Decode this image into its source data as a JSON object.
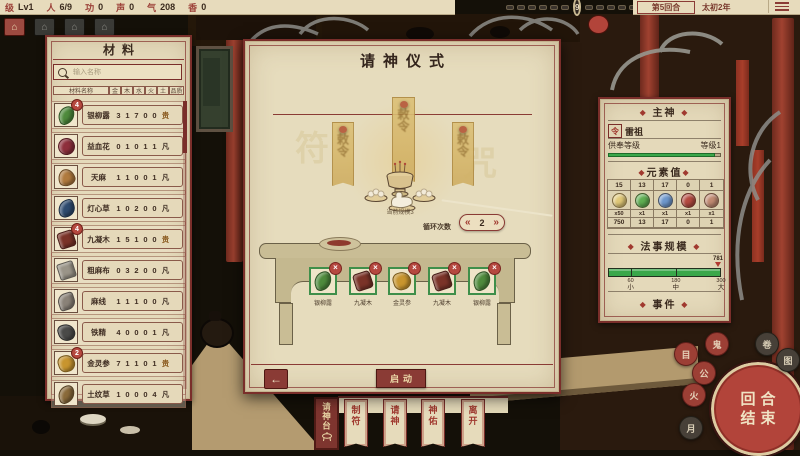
{
  "top_bar": {
    "stats": [
      {
        "label": "级",
        "value": "Lv1"
      },
      {
        "label": "人",
        "value": "6/9"
      },
      {
        "label": "功",
        "value": "0"
      },
      {
        "label": "声",
        "value": "0"
      },
      {
        "label": "气",
        "value": "208"
      },
      {
        "label": "香",
        "value": "0"
      }
    ],
    "turn_badge": "9",
    "round": "第5回合",
    "year": "太初2年"
  },
  "view_buttons": [
    {
      "name": "view-toggle-1",
      "glyph": "⌂",
      "active": true
    },
    {
      "name": "view-toggle-2",
      "glyph": "⌂",
      "active": false
    },
    {
      "name": "view-toggle-3",
      "glyph": "⌂",
      "active": false
    },
    {
      "name": "view-toggle-4",
      "glyph": "⌂",
      "active": false
    }
  ],
  "materials": {
    "title": "材料",
    "search_placeholder": "输入名称",
    "header": {
      "name": "材料名称",
      "elements": [
        "金",
        "木",
        "水",
        "火",
        "土"
      ],
      "quality": "品质"
    },
    "quality_colors": {
      "贵": "#8a5a1e",
      "凡": "#4a3a2e"
    },
    "items": [
      {
        "name": "银柳露",
        "values": [
          "3",
          "1",
          "7",
          "0",
          "0"
        ],
        "quality": "贵",
        "badge": "4",
        "color": "#4e8a3c",
        "shape": "leaf"
      },
      {
        "name": "益血花",
        "values": [
          "0",
          "1",
          "0",
          "1",
          "1"
        ],
        "quality": "凡",
        "badge": "",
        "color": "#8e2f3c",
        "shape": "flower"
      },
      {
        "name": "天麻",
        "values": [
          "1",
          "1",
          "0",
          "0",
          "1"
        ],
        "quality": "凡",
        "badge": "",
        "color": "#b07a3e",
        "shape": "tuber"
      },
      {
        "name": "灯心草",
        "values": [
          "1",
          "0",
          "2",
          "0",
          "0"
        ],
        "quality": "凡",
        "badge": "",
        "color": "#2e4a6e",
        "shape": "grass"
      },
      {
        "name": "九凝木",
        "values": [
          "1",
          "5",
          "1",
          "0",
          "0"
        ],
        "quality": "贵",
        "badge": "4",
        "color": "#7a3328",
        "shape": "wood"
      },
      {
        "name": "粗麻布",
        "values": [
          "0",
          "3",
          "2",
          "0",
          "0"
        ],
        "quality": "凡",
        "badge": "",
        "color": "#9a9488",
        "shape": "cloth"
      },
      {
        "name": "麻线",
        "values": [
          "1",
          "1",
          "1",
          "0",
          "0"
        ],
        "quality": "凡",
        "badge": "",
        "color": "#8a8278",
        "shape": "thread"
      },
      {
        "name": "铁精",
        "values": [
          "4",
          "0",
          "0",
          "0",
          "1"
        ],
        "quality": "凡",
        "badge": "",
        "color": "#4a4a48",
        "shape": "ore"
      },
      {
        "name": "金灵参",
        "values": [
          "7",
          "1",
          "1",
          "0",
          "1"
        ],
        "quality": "贵",
        "badge": "2",
        "color": "#c8952e",
        "shape": "root"
      },
      {
        "name": "土纹草",
        "values": [
          "1",
          "0",
          "0",
          "0",
          "4"
        ],
        "quality": "凡",
        "badge": "",
        "color": "#8a6a3a",
        "shape": "leaf"
      }
    ]
  },
  "ritual": {
    "title": "请神仪式",
    "banner_glyph": "敕令",
    "burner_caption": "当前规模3",
    "cycle_label": "循环次数",
    "cycle_prev": "«",
    "cycle_value": "2",
    "cycle_next": "»",
    "slots": [
      {
        "name": "银柳露",
        "color": "#4e8a3c",
        "shape": "leaf"
      },
      {
        "name": "九凝木",
        "color": "#7a3328",
        "shape": "wood"
      },
      {
        "name": "金灵参",
        "color": "#c8952e",
        "shape": "root"
      },
      {
        "name": "九凝木",
        "color": "#7a3328",
        "shape": "wood"
      },
      {
        "name": "银柳露",
        "color": "#4e8a3c",
        "shape": "leaf"
      }
    ],
    "remove_glyph": "×",
    "back_glyph": "←",
    "start_label": "启动"
  },
  "god_panel": {
    "diamond": "◆",
    "main_header": "主神",
    "god_icon_glyph": "令",
    "god_name": "雷祖",
    "worship_label": "供奉等级",
    "worship_value": "等级1",
    "elements_header": "元素值",
    "elements": [
      {
        "value": "15",
        "mult": "x50",
        "total": "750",
        "color": "#e0c878"
      },
      {
        "value": "13",
        "mult": "x1",
        "total": "13",
        "color": "#5fae52"
      },
      {
        "value": "17",
        "mult": "x1",
        "total": "17",
        "color": "#6e97cc"
      },
      {
        "value": "0",
        "mult": "x1",
        "total": "0",
        "color": "#b44a40"
      },
      {
        "value": "1",
        "mult": "x1",
        "total": "1",
        "color": "#c08a72"
      }
    ],
    "scale_header": "法事规模",
    "scale_marker": "781",
    "scale_max": 300,
    "scale_ticks": [
      {
        "num": "60",
        "label": "小",
        "pos": 60
      },
      {
        "num": "180",
        "label": "中",
        "pos": 180
      },
      {
        "num": "300",
        "label": "大",
        "pos": 300
      }
    ],
    "bar_color": "#3aa74a",
    "events_header": "事件"
  },
  "bottom_tabs": [
    {
      "label": "请神台",
      "active": true
    },
    {
      "label": "制符",
      "active": false
    },
    {
      "label": "请神",
      "active": false
    },
    {
      "label": "神佑",
      "active": false
    },
    {
      "label": "离开",
      "active": false
    }
  ],
  "end_turn": {
    "line1": "回合",
    "line2": "结束"
  },
  "seals": [
    {
      "glyph": "目",
      "tone": "red"
    },
    {
      "glyph": "鬼",
      "tone": "red"
    },
    {
      "glyph": "卷",
      "tone": "dark"
    },
    {
      "glyph": "图",
      "tone": "dark"
    },
    {
      "glyph": "公",
      "tone": "red"
    },
    {
      "glyph": "火",
      "tone": "red"
    },
    {
      "glyph": "月",
      "tone": "dark"
    }
  ],
  "colors": {
    "accent": "#8a3b35",
    "slot_green": "#3f8f4a",
    "gold": "#d9bc74"
  }
}
